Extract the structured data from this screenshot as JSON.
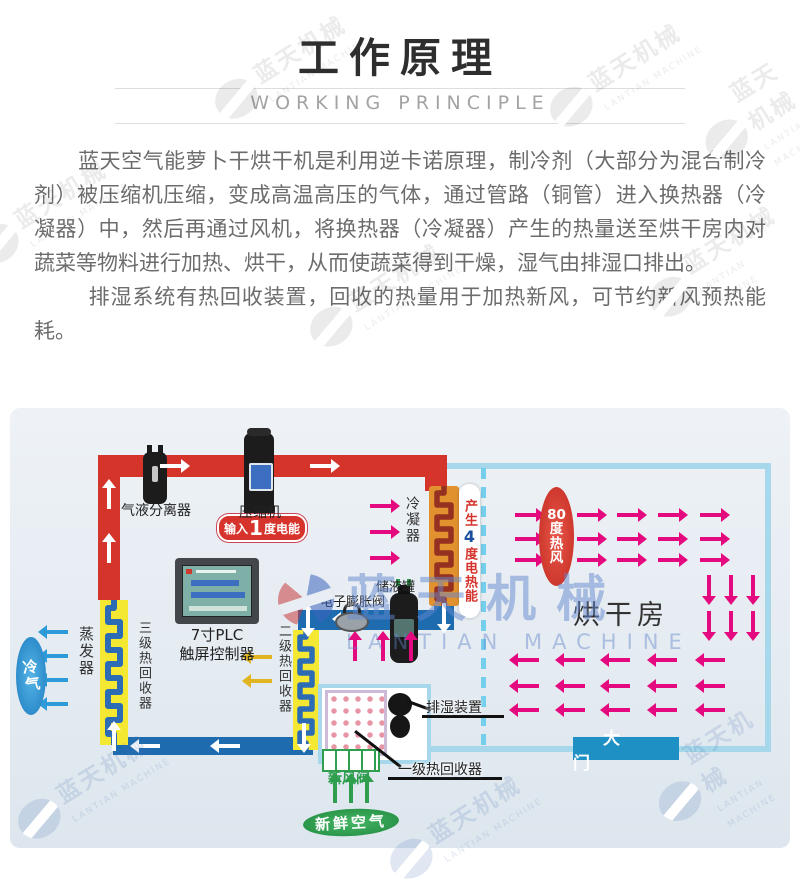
{
  "header": {
    "title": "工作原理",
    "subtitle": "WORKING PRINCIPLE"
  },
  "intro": {
    "p1": "蓝天空气能萝卜干烘干机是利用逆卡诺原理，制冷剂（大部分为混合制冷剂）被压缩机压缩，变成高温高压的气体，通过管路（铜管）进入换热器（冷凝器）中，然后再通过风机，将换热器（冷凝器）产生的热量送至烘干房内对蔬菜等物料进行加热、烘干，从而使蔬菜得到干燥，湿气由排湿口排出。",
    "p2": "排湿系统有热回收装置，回收的热量用于加热新风，可节约新风预热能耗。"
  },
  "watermark": {
    "cn": "蓝天机械",
    "en": "LANTIAN MACHINE"
  },
  "diagram": {
    "labels": {
      "separator": "气液分离器",
      "compressor": "压缩机",
      "input_badge": {
        "prefix": "输入",
        "value": "1",
        "suffix": "度电能"
      },
      "condenser": "冷凝器",
      "heat_badge": {
        "prefix": "产生",
        "value": "4",
        "suffix": "度电热能"
      },
      "tank": "储液罐",
      "expansion_valve": "电子膨胀阀",
      "plc_line1": "7寸PLC",
      "plc_line2": "触屏控制器",
      "evaporator": "蒸发器",
      "recovery3": "三级热回收器",
      "recovery2": "二级热回收器",
      "recovery1": "一级热回收器",
      "cold_air": "冷气",
      "hot_air_chars": [
        "80",
        "度",
        "热",
        "风"
      ],
      "drying_room": "烘干房",
      "door": "大门",
      "exhaust_device": "排湿装置",
      "fresh_valve": "新风阀",
      "fresh_air": "新鲜空气"
    },
    "colors": {
      "pipe_hot": "#d5342b",
      "pipe_cold": "#1e6bb0",
      "arrow_pink": "#e5097f",
      "arrow_blue": "#2f9ad8",
      "arrow_yellow": "#e0b520",
      "arrow_green": "#2f9e4f",
      "coil_bg": "#f4e832",
      "coil_stroke": "#2c6cb5",
      "condenser_bg": "#e2912f",
      "condenser_stroke": "#953120",
      "room_border": "#a6d7ea",
      "door_bg": "#1f90c4",
      "badge_bg": "#d5332c"
    },
    "airflow": {
      "condenser-in": {
        "dir": "right",
        "color": "#e5097f",
        "rows": [
          96,
          122,
          148
        ],
        "cols": [
          360
        ]
      },
      "hot-right": {
        "dir": "right",
        "color": "#e5097f",
        "rows": [
          105,
          129,
          150
        ],
        "cols": [
          505,
          567,
          607,
          648,
          690
        ]
      },
      "hot-down": {
        "dir": "down",
        "color": "#e5097f",
        "rows": [
          176,
          212
        ],
        "cols": [
          688,
          710,
          732
        ]
      },
      "hot-left": {
        "dir": "left",
        "color": "#e5097f",
        "rows": [
          250,
          276,
          300
        ],
        "cols": [
          507,
          553,
          598,
          645,
          693
        ]
      },
      "valve-up": {
        "dir": "up",
        "color": "#e5097f",
        "rows": [
          240
        ],
        "cols": [
          334,
          362,
          390
        ]
      },
      "cold-left": {
        "dir": "left",
        "color": "#2f9ad8",
        "rows": [
          222,
          246,
          270,
          294
        ],
        "cols": [
          36
        ]
      },
      "recovery2-left": {
        "dir": "left",
        "color": "#e0b520",
        "rows": [
          247,
          271
        ],
        "cols": [
          240
        ]
      },
      "fresh-up": {
        "dir": "up",
        "color": "#2f9e4f",
        "rows": [
          382
        ],
        "cols": [
          314,
          330,
          346
        ]
      }
    }
  }
}
